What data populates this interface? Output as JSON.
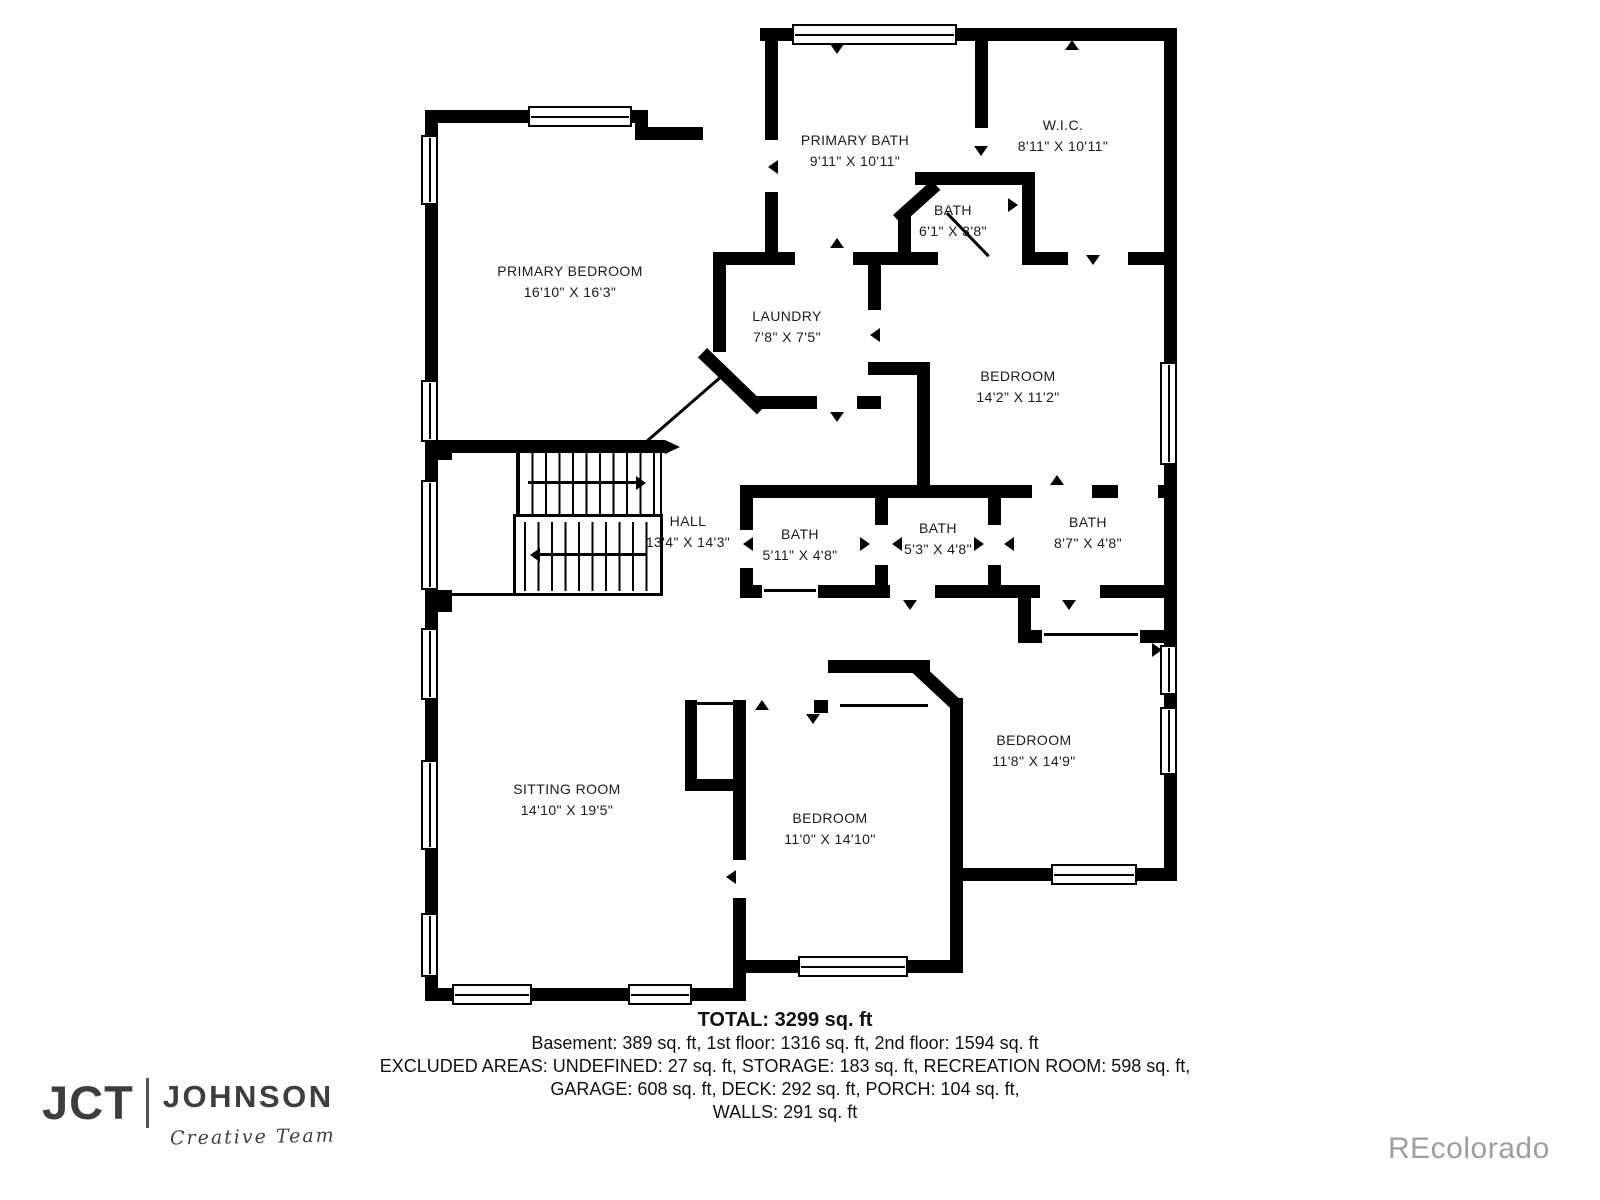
{
  "rooms": {
    "primary_bath": {
      "name": "PRIMARY BATH",
      "dims": "9'11\" X 10'11\""
    },
    "wic": {
      "name": "W.I.C.",
      "dims": "8'11\" X 10'11\""
    },
    "bath_small": {
      "name": "BATH",
      "dims": "6'1\" X 3'8\""
    },
    "primary_bedroom": {
      "name": "PRIMARY BEDROOM",
      "dims": "16'10\" X 16'3\""
    },
    "laundry": {
      "name": "LAUNDRY",
      "dims": "7'8\" X 7'5\""
    },
    "bedroom_ne": {
      "name": "BEDROOM",
      "dims": "14'2\" X 11'2\""
    },
    "hall": {
      "name": "HALL",
      "dims": "13'4\" X 14'3\""
    },
    "bath_1": {
      "name": "BATH",
      "dims": "5'11\" X 4'8\""
    },
    "bath_2": {
      "name": "BATH",
      "dims": "5'3\" X 4'8\""
    },
    "bath_3": {
      "name": "BATH",
      "dims": "8'7\" X 4'8\""
    },
    "sitting_room": {
      "name": "SITTING ROOM",
      "dims": "14'10\" X 19'5\""
    },
    "bedroom_e": {
      "name": "BEDROOM",
      "dims": "11'8\" X 14'9\""
    },
    "bedroom_s": {
      "name": "BEDROOM",
      "dims": "11'0\" X 14'10\""
    }
  },
  "summary": {
    "total": "TOTAL: 3299 sq. ft",
    "line1": "Basement: 389 sq. ft, 1st floor: 1316 sq. ft, 2nd floor: 1594 sq. ft",
    "line2": "EXCLUDED AREAS: UNDEFINED: 27 sq. ft, STORAGE: 183 sq. ft, RECREATION ROOM: 598 sq. ft,",
    "line3": "GARAGE: 608 sq. ft, DECK: 292 sq. ft, PORCH: 104 sq. ft,",
    "line4": "WALLS: 291 sq. ft"
  },
  "branding": {
    "logo_mark": "JCT",
    "logo_name": "JOHNSON",
    "logo_tagline": "Creative Team",
    "watermark": "REcolorado"
  },
  "colors": {
    "wall": "#000000",
    "text": "#1b1b1b",
    "logo": "#3e3e3e",
    "watermark": "#9e9e9e",
    "background": "#ffffff"
  }
}
